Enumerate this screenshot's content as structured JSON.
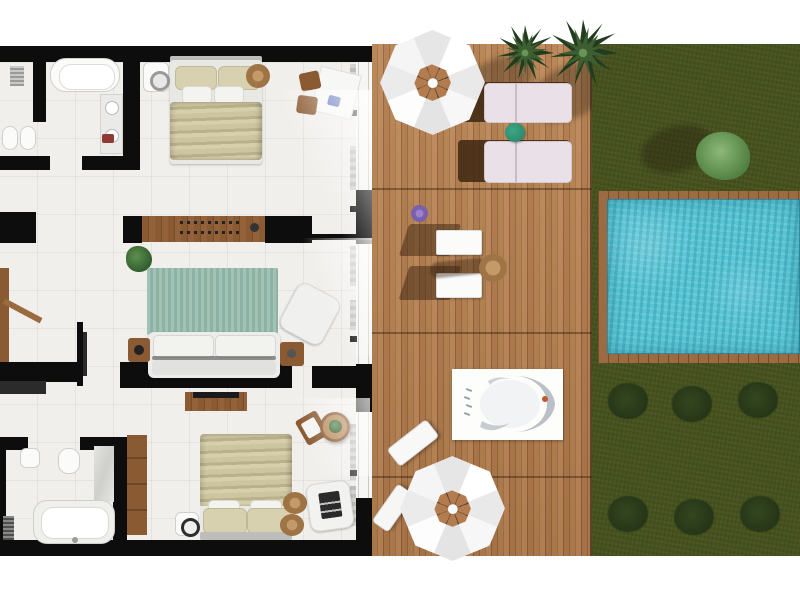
{
  "scene": {
    "title": "Top-down 3D rendered floor plan of a villa suite with sun deck, lawn and private pool",
    "rooms": [
      "bathroom-top",
      "bedroom-top",
      "entry-hall",
      "living-room",
      "bedroom-bottom",
      "bathroom-bottom",
      "sun-deck",
      "lawn",
      "swimming-pool"
    ],
    "objects": {
      "bathroom_top": [
        "bathtub",
        "shower-closet",
        "shelf-unit",
        "vanity-sink",
        "toilet",
        "bidet",
        "red-towel"
      ],
      "bedroom_top": [
        "double-bed",
        "beige-pillows",
        "washing-machine",
        "round-pouf",
        "desk",
        "two-wooden-chairs",
        "wooden-sideboard",
        "antler-decor"
      ],
      "entry_hall": [
        "entrance-door",
        "potted-plant",
        "tv-partition",
        "dark-shelf"
      ],
      "living_room": [
        "teal-area-rug",
        "white-sofa",
        "armchair",
        "side-table-left",
        "side-table-right",
        "media-console-tv"
      ],
      "bedroom_bottom": [
        "double-bed",
        "nightstand-lamp",
        "armchair-art-cushion",
        "jute-rug-1",
        "jute-rug-2",
        "wooden-chair",
        "round-table-plant",
        "wardrobe"
      ],
      "bathroom_bottom": [
        "bathtub",
        "radiator",
        "toilet",
        "sink",
        "marble-shower-wall"
      ],
      "sun_deck": [
        "parasol-top",
        "parasol-bottom",
        "sun-lounger-1",
        "sun-lounger-2",
        "green-side-table",
        "palm-tree-1",
        "palm-tree-2",
        "white-chair-1",
        "white-chair-2",
        "round-stool",
        "outdoor-bathtub-platform",
        "angled-lounger-1",
        "angled-lounger-2",
        "purple-flower"
      ],
      "lawn": [
        "light-green-bush",
        "dark-shrub-row-top",
        "dark-shrub-row-bottom"
      ],
      "swimming_pool": [
        "wooden-pool-deck-frame",
        "turquoise-water"
      ]
    }
  },
  "colors": {
    "background": "#ffffff",
    "wall": "#0d0d0d",
    "floor_tile": "#f1efec",
    "deck_wood": "#b5814f",
    "deck_wood_dark": "#8f6038",
    "furniture_wood": "#8a5a33",
    "grass": "#46511f",
    "shrub": "#2c3d1c",
    "bush": "#6fa35e",
    "pool_water": "#58c5d5",
    "pool_frame_wood": "#9c6b42",
    "rug": "#95bcae",
    "bedding": "#cdc5a0",
    "sofa": "#ececea",
    "lounger_mattress": "#e9e0e8",
    "umbrella": "#f5f5f5",
    "jute_rug": "#a87848",
    "plant": "#3f7a3c",
    "accent_towel": "#8e3b34",
    "accent_flower": "#7a5fae",
    "side_table_green": "#2e8b6e"
  }
}
